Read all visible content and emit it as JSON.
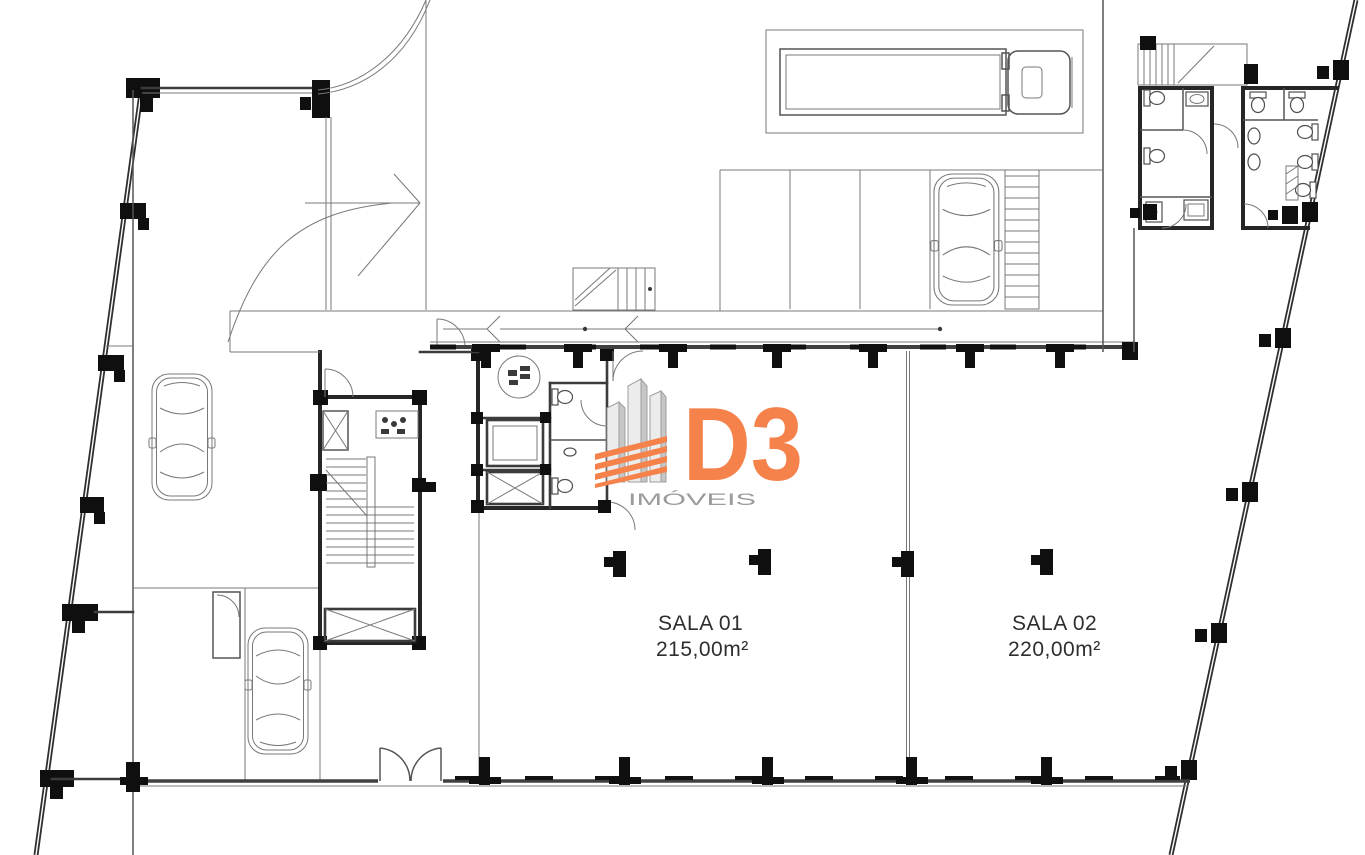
{
  "meta": {
    "kind": "architectural-floor-plan",
    "width_px": 1365,
    "height_px": 855
  },
  "rooms": [
    {
      "id": "sala-01",
      "name": "SALA 01",
      "area": "215,00m²"
    },
    {
      "id": "sala-02",
      "name": "SALA 02",
      "area": "220,00m²"
    }
  ],
  "logo": {
    "brand": "D3",
    "tagline": "IMÓVEIS",
    "colors": {
      "orange": "#F5814B",
      "tagline_gray": "#9B9B9B",
      "tower_light": "#ECECEC",
      "tower_shade": "#C6C6C6",
      "tower_outline": "#9E9E9E"
    }
  },
  "plan": {
    "colors": {
      "background": "#FFFFFF",
      "wall_dark": "#262626",
      "wall_medium": "#3C3C3C",
      "detail_line": "#787878",
      "column_black": "#0F0F0F"
    },
    "icons": [
      "car-icon",
      "truck-icon",
      "stairs-icon",
      "elevator-x-icon",
      "toilet-icon",
      "sink-icon",
      "door-arc-icon",
      "double-door-icon",
      "direction-arrow-icon",
      "hatched-walkway-icon",
      "round-table-icon"
    ],
    "vehicle_count": {
      "cars": 3,
      "trucks": 1
    }
  }
}
